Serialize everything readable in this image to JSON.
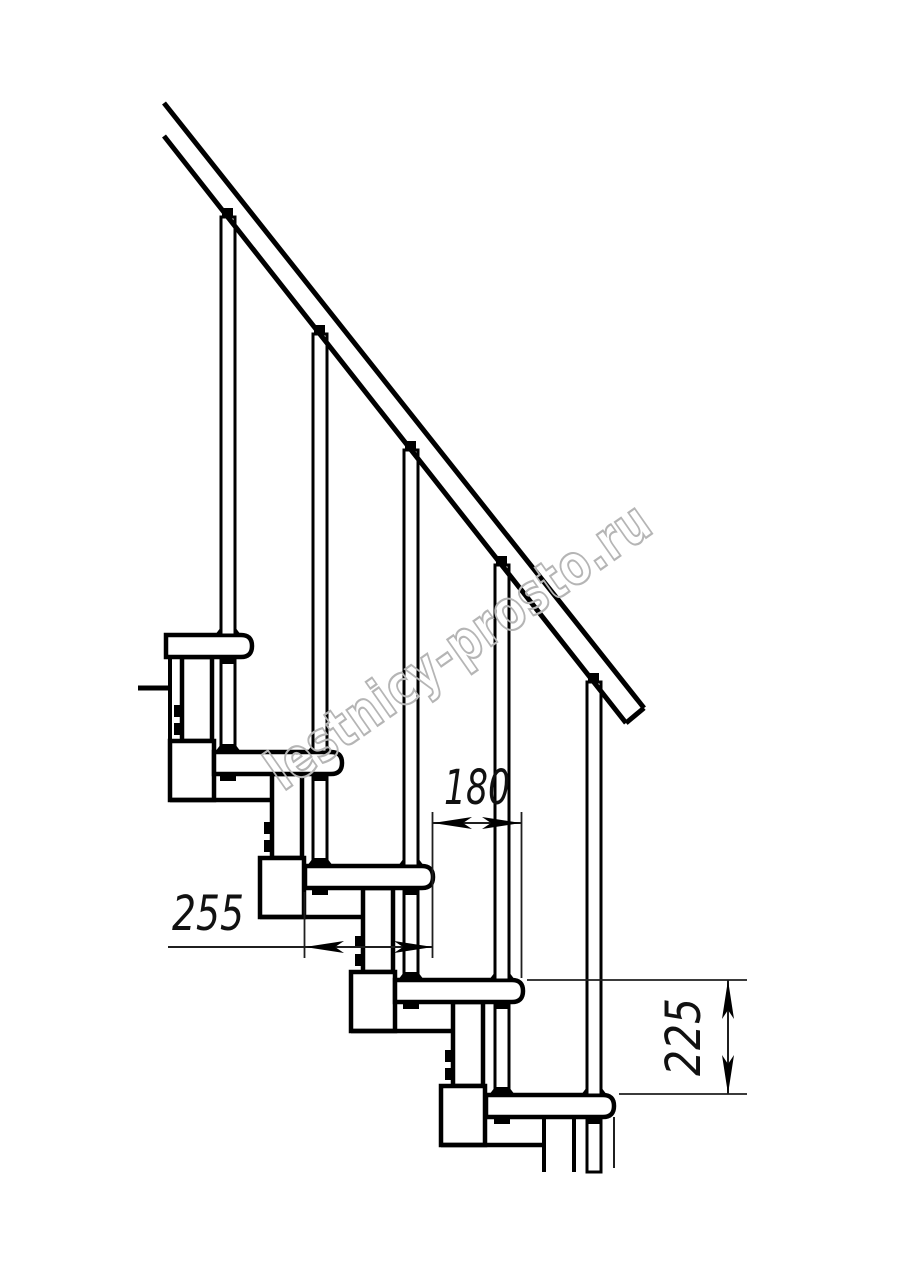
{
  "title": "Modular staircase side-view technical drawing",
  "dimensions": {
    "tread_depth": {
      "value": "255",
      "orientation": "horizontal"
    },
    "step_run": {
      "value": "180",
      "orientation": "horizontal"
    },
    "step_rise": {
      "value": "225",
      "orientation": "vertical"
    }
  },
  "watermark": {
    "text": "lestnicy-prosto.ru",
    "color": "#b5b5b5"
  },
  "colors": {
    "line": "#000000",
    "background": "#ffffff",
    "dimension_line": "#1f1f1f"
  }
}
